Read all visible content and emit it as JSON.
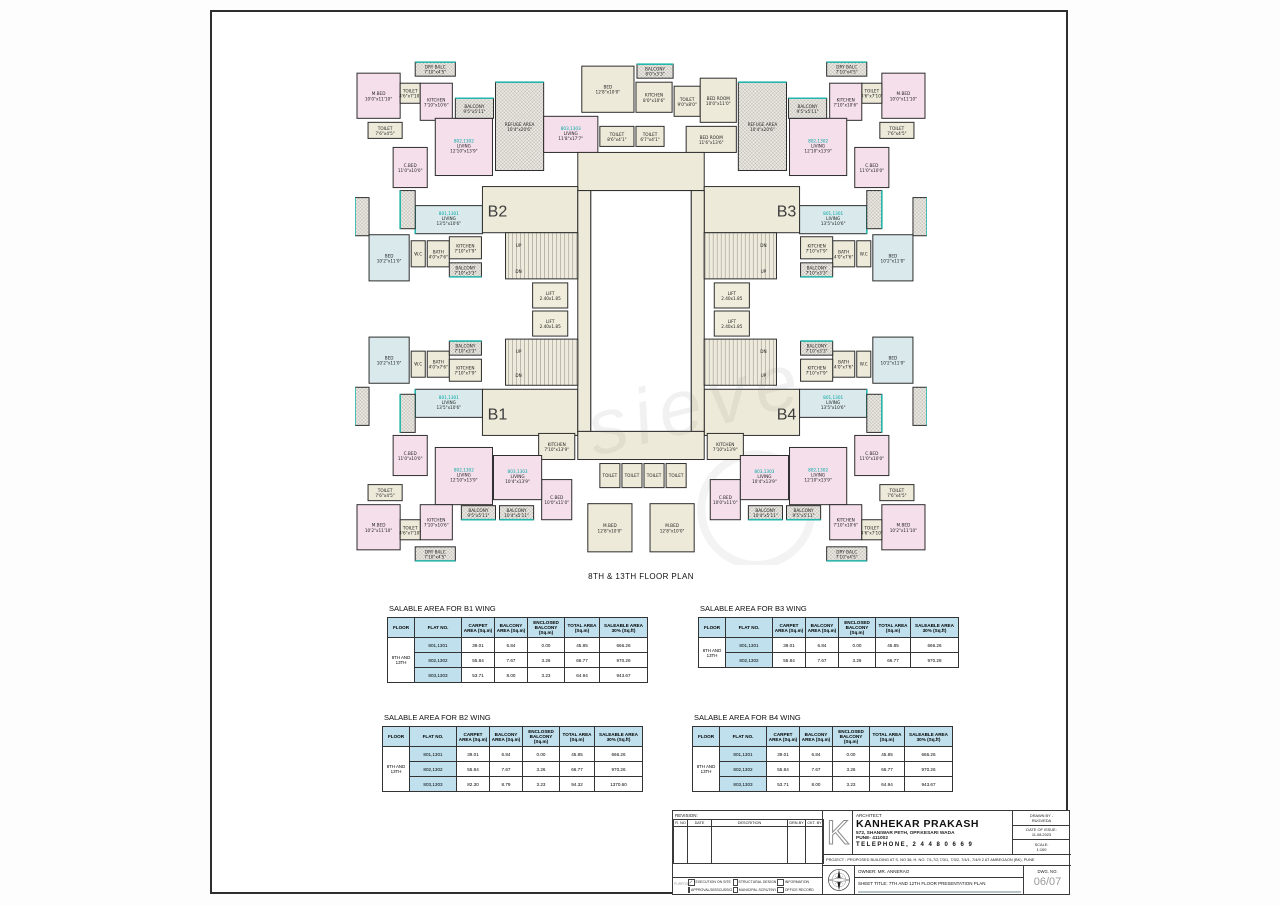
{
  "sheet": {
    "plan_title": "8TH & 13TH FLOOR PLAN",
    "watermark": "sieve"
  },
  "plan": {
    "wings": [
      {
        "label": "B2",
        "x": 142,
        "y": 158
      },
      {
        "label": "B3",
        "x": 430,
        "y": 158
      },
      {
        "label": "B1",
        "x": 142,
        "y": 360
      },
      {
        "label": "B4",
        "x": 430,
        "y": 360
      }
    ],
    "texts": [
      {
        "t": "UP",
        "x": 163,
        "y": 188
      },
      {
        "t": "DN",
        "x": 163,
        "y": 214
      },
      {
        "t": "UP",
        "x": 163,
        "y": 294
      },
      {
        "t": "DN",
        "x": 163,
        "y": 318
      },
      {
        "t": "DN",
        "x": 407,
        "y": 188
      },
      {
        "t": "UP",
        "x": 407,
        "y": 214
      },
      {
        "t": "DN",
        "x": 407,
        "y": 294
      },
      {
        "t": "UP",
        "x": 407,
        "y": 318
      }
    ],
    "rooms": [
      [
        140,
        24,
        48,
        88,
        "H",
        "REFUGE AREA",
        "10'4\"x20'6\"",
        "",
        "t"
      ],
      [
        382,
        24,
        48,
        88,
        "H",
        "REFUGE AREA",
        "10'4\"x20'6\"",
        "",
        "t"
      ],
      [
        226,
        8,
        52,
        46,
        "C",
        "BED",
        "12'8\"x10'0\""
      ],
      [
        281,
        6,
        36,
        14,
        "H",
        "BALCONY",
        "8'0\"x3'3\"",
        "",
        "t"
      ],
      [
        280,
        24,
        36,
        30,
        "C",
        "KITCHEN",
        "8'0\"x10'6\""
      ],
      [
        318,
        28,
        26,
        30,
        "C",
        "TOILET",
        "9'0\"x8'0\""
      ],
      [
        344,
        20,
        36,
        44,
        "C",
        "BED ROOM",
        "10'0\"x11'0\""
      ],
      [
        330,
        68,
        50,
        26,
        "C",
        "BED ROOM",
        "11'6\"x13'6\""
      ],
      [
        188,
        58,
        54,
        36,
        "P",
        "LIVING",
        "11'8\"x17'7\"",
        "803,1303"
      ],
      [
        244,
        68,
        34,
        20,
        "C",
        "TOILET",
        "8'6\"x4'1\""
      ],
      [
        280,
        68,
        28,
        20,
        "C",
        "TOILET",
        "6'7\"x4'1\""
      ],
      [
        222,
        94,
        126,
        38,
        "C"
      ],
      [
        2,
        15,
        43,
        45,
        "P",
        "M.BED",
        "10'0\"x11'10\""
      ],
      [
        60,
        4,
        40,
        14,
        "H",
        "DRY BALC",
        "7'10\"x4'5\"",
        "",
        "t"
      ],
      [
        45,
        25,
        20,
        20,
        "C",
        "TOILET",
        "4'6\"x7'10\""
      ],
      [
        65,
        25,
        32,
        37,
        "P",
        "KITCHEN",
        "7'10\"x10'6\""
      ],
      [
        13,
        64,
        34,
        16,
        "C",
        "TOILET",
        "7'6\"x4'5\""
      ],
      [
        38,
        89,
        34,
        40,
        "P",
        "C.BED",
        "11'0\"x10'0\""
      ],
      [
        80,
        60,
        57,
        57,
        "P",
        "LIVING",
        "12'10\"x13'9\"",
        "802,1302"
      ],
      [
        100,
        40,
        38,
        20,
        "H",
        "BALCONY",
        "9'5\"x5'11\"",
        "",
        "t"
      ],
      [
        60,
        147,
        67,
        28,
        "B",
        "LIVING",
        "13'5\"x10'6\"",
        "801,1301",
        "l"
      ],
      [
        45,
        132,
        15,
        38,
        "H",
        "",
        "",
        "",
        "l"
      ],
      [
        0,
        139,
        14,
        38,
        "H",
        "",
        "",
        "",
        "l"
      ],
      [
        525,
        15,
        43,
        45,
        "P",
        "M.BED",
        "10'0\"x11'10\""
      ],
      [
        470,
        4,
        40,
        14,
        "H",
        "DRY BALC",
        "7'10\"x4'5\"",
        "",
        "t"
      ],
      [
        505,
        25,
        20,
        20,
        "C",
        "TOILET",
        "4'6\"x7'10\""
      ],
      [
        473,
        25,
        32,
        37,
        "P",
        "KITCHEN",
        "7'10\"x10'6\""
      ],
      [
        523,
        64,
        34,
        16,
        "C",
        "TOILET",
        "7'6\"x4'5\""
      ],
      [
        498,
        89,
        34,
        40,
        "P",
        "C.BED",
        "11'0\"x10'0\""
      ],
      [
        433,
        60,
        57,
        57,
        "P",
        "LIVING",
        "12'10\"x13'9\"",
        "802,1302"
      ],
      [
        432,
        40,
        38,
        20,
        "H",
        "BALCONY",
        "9'5\"x5'11\"",
        "",
        "t"
      ],
      [
        443,
        147,
        67,
        28,
        "B",
        "LIVING",
        "13'5\"x10'6\"",
        "801,1301",
        "r"
      ],
      [
        510,
        132,
        15,
        38,
        "H",
        "",
        "",
        "",
        "r"
      ],
      [
        556,
        139,
        14,
        38,
        "H",
        "",
        "",
        "",
        "r"
      ],
      [
        14,
        176,
        40,
        46,
        "B",
        "BED",
        "10'2\"x11'0\""
      ],
      [
        56,
        182,
        14,
        26,
        "C",
        "W.C",
        ""
      ],
      [
        72,
        182,
        22,
        26,
        "C",
        "BATH",
        "4'0\"x7'6\""
      ],
      [
        94,
        178,
        32,
        22,
        "C",
        "KITCHEN",
        "7'10\"x7'9\""
      ],
      [
        94,
        204,
        32,
        14,
        "H",
        "BALCONY",
        "7'10\"x3'3\"",
        "",
        "b"
      ],
      [
        14,
        278,
        40,
        46,
        "B",
        "BED",
        "10'2\"x11'0\""
      ],
      [
        56,
        292,
        14,
        26,
        "C",
        "W.C",
        ""
      ],
      [
        72,
        292,
        22,
        26,
        "C",
        "BATH",
        "4'0\"x7'6\""
      ],
      [
        94,
        300,
        32,
        22,
        "C",
        "KITCHEN",
        "7'10\"x7'9\""
      ],
      [
        94,
        282,
        32,
        14,
        "H",
        "BALCONY",
        "7'10\"x3'3\"",
        "",
        "t"
      ],
      [
        516,
        176,
        40,
        46,
        "B",
        "BED",
        "10'2\"x11'0\""
      ],
      [
        500,
        182,
        14,
        26,
        "C",
        "W.C",
        ""
      ],
      [
        476,
        182,
        22,
        26,
        "C",
        "BATH",
        "4'0\"x7'6\""
      ],
      [
        444,
        178,
        32,
        22,
        "C",
        "KITCHEN",
        "7'10\"x7'9\""
      ],
      [
        444,
        204,
        32,
        14,
        "H",
        "BALCONY",
        "7'10\"x3'3\"",
        "",
        "b"
      ],
      [
        516,
        278,
        40,
        46,
        "B",
        "BED",
        "10'2\"x11'0\""
      ],
      [
        500,
        292,
        14,
        26,
        "C",
        "W.C",
        ""
      ],
      [
        476,
        292,
        22,
        26,
        "C",
        "BATH",
        "4'0\"x7'6\""
      ],
      [
        444,
        300,
        32,
        22,
        "C",
        "KITCHEN",
        "7'10\"x7'9\""
      ],
      [
        444,
        282,
        32,
        14,
        "H",
        "BALCONY",
        "7'10\"x3'3\"",
        "",
        "t"
      ],
      [
        127,
        128,
        95,
        46,
        "C"
      ],
      [
        348,
        128,
        95,
        46,
        "C"
      ],
      [
        127,
        330,
        95,
        46,
        "C"
      ],
      [
        348,
        330,
        95,
        46,
        "C"
      ],
      [
        222,
        132,
        13,
        240,
        "C"
      ],
      [
        335,
        132,
        13,
        240,
        "C"
      ],
      [
        235,
        132,
        100,
        240,
        "W"
      ],
      [
        150,
        174,
        72,
        46,
        "S"
      ],
      [
        177,
        224,
        35,
        25,
        "L",
        "LIFT",
        "2.40x1.85"
      ],
      [
        177,
        252,
        35,
        25,
        "L",
        "LIFT",
        "2.40x1.85"
      ],
      [
        150,
        280,
        72,
        46,
        "S"
      ],
      [
        348,
        174,
        72,
        46,
        "S"
      ],
      [
        358,
        224,
        35,
        25,
        "L",
        "LIFT",
        "2.40x1.85"
      ],
      [
        358,
        252,
        35,
        25,
        "L",
        "LIFT",
        "2.40x1.85"
      ],
      [
        348,
        280,
        72,
        46,
        "S"
      ],
      [
        222,
        372,
        126,
        28,
        "C"
      ],
      [
        183,
        374,
        36,
        26,
        "C",
        "KITCHEN",
        "7'10\"x13'9\""
      ],
      [
        351,
        374,
        36,
        26,
        "C",
        "KITCHEN",
        "7'10\"x13'9\""
      ],
      [
        244,
        404,
        20,
        24,
        "C",
        "TOILET",
        ""
      ],
      [
        266,
        404,
        20,
        24,
        "C",
        "TOILET",
        ""
      ],
      [
        288,
        404,
        20,
        24,
        "C",
        "TOILET",
        ""
      ],
      [
        310,
        404,
        20,
        24,
        "C",
        "TOILET",
        ""
      ],
      [
        232,
        444,
        44,
        48,
        "C",
        "M.BED",
        "12'8\"x10'0\""
      ],
      [
        294,
        444,
        44,
        48,
        "C",
        "M.BED",
        "12'8\"x10'0\""
      ],
      [
        186,
        420,
        30,
        40,
        "P",
        "C.BED",
        "10'0\"x11'0\""
      ],
      [
        354,
        420,
        30,
        40,
        "P",
        "C.BED",
        "10'0\"x11'0\""
      ],
      [
        138,
        396,
        48,
        44,
        "P",
        "LIVING",
        "10'4\"x13'9\"",
        "803,1303"
      ],
      [
        384,
        396,
        48,
        44,
        "P",
        "LIVING",
        "10'4\"x13'9\"",
        "803,1303"
      ],
      [
        106,
        446,
        34,
        14,
        "H",
        "BALCONY",
        "9'5\"x5'11\"",
        "",
        "b"
      ],
      [
        144,
        446,
        34,
        14,
        "H",
        "BALCONY",
        "10'4\"x5'11\"",
        "",
        "b"
      ],
      [
        430,
        446,
        34,
        14,
        "H",
        "BALCONY",
        "9'5\"x5'11\"",
        "",
        "b"
      ],
      [
        392,
        446,
        34,
        14,
        "H",
        "BALCONY",
        "10'4\"x5'11\"",
        "",
        "b"
      ],
      [
        60,
        330,
        67,
        28,
        "B",
        "LIVING",
        "13'5\"x10'6\"",
        "801,1301",
        "l"
      ],
      [
        45,
        335,
        15,
        38,
        "H",
        "",
        "",
        "",
        "l"
      ],
      [
        0,
        328,
        14,
        38,
        "H",
        "",
        "",
        "",
        "l"
      ],
      [
        38,
        376,
        34,
        40,
        "P",
        "C.BED",
        "11'0\"x10'0\""
      ],
      [
        80,
        388,
        57,
        57,
        "P",
        "LIVING",
        "12'10\"x13'9\"",
        "802,1302"
      ],
      [
        2,
        445,
        43,
        45,
        "P",
        "M.BED",
        "10'2\"x11'10\""
      ],
      [
        13,
        425,
        34,
        16,
        "C",
        "TOILET",
        "7'6\"x4'5\""
      ],
      [
        65,
        445,
        32,
        35,
        "P",
        "KITCHEN",
        "7'10\"x10'6\""
      ],
      [
        45,
        460,
        20,
        20,
        "C",
        "TOILET",
        "4'6\"x7'10\""
      ],
      [
        60,
        487,
        40,
        14,
        "H",
        "DRY BALC",
        "7'10\"x4'5\"",
        "",
        "b"
      ],
      [
        443,
        330,
        67,
        28,
        "B",
        "LIVING",
        "13'5\"x10'6\"",
        "801,1301",
        "r"
      ],
      [
        510,
        335,
        15,
        38,
        "H",
        "",
        "",
        "",
        "r"
      ],
      [
        556,
        328,
        14,
        38,
        "H",
        "",
        "",
        "",
        "r"
      ],
      [
        498,
        376,
        34,
        40,
        "P",
        "C.BED",
        "11'0\"x10'0\""
      ],
      [
        433,
        388,
        57,
        57,
        "P",
        "LIVING",
        "12'10\"x13'9\"",
        "802,1302"
      ],
      [
        525,
        445,
        43,
        45,
        "P",
        "M.BED",
        "10'2\"x11'10\""
      ],
      [
        523,
        425,
        34,
        16,
        "C",
        "TOILET",
        "7'6\"x4'5\""
      ],
      [
        473,
        445,
        32,
        35,
        "P",
        "KITCHEN",
        "7'10\"x10'6\""
      ],
      [
        505,
        460,
        20,
        20,
        "C",
        "TOILET",
        "4'6\"x7'10\""
      ],
      [
        470,
        487,
        40,
        14,
        "H",
        "DRY BALC",
        "7'10\"x4'5\"",
        "",
        "b"
      ]
    ]
  },
  "tables": {
    "headers": [
      "FLOOR",
      "FLAT NO.",
      "CARPET AREA (Sq.m)",
      "BALCONY AREA (Sq.m)",
      "ENCLOSED BALCONY (Sq.m)",
      "TOTAL AREA (Sq.m)",
      "SALEABLE AREA 30% (Sq.ft)"
    ],
    "floor_label": "8TH AND 13TH",
    "list": [
      {
        "title": "SALABLE AREA FOR B1 WING",
        "rows": [
          [
            "801,1301",
            "39.01",
            "6.84",
            "0.00",
            "45.85",
            "666.26"
          ],
          [
            "802,1302",
            "55.84",
            "7.67",
            "3.26",
            "66.77",
            "970.26"
          ],
          [
            "803,1303",
            "53.71",
            "8.00",
            "3.23",
            "64.94",
            "943.67"
          ]
        ]
      },
      {
        "title": "SALABLE AREA FOR B3 WING",
        "rows": [
          [
            "801,1301",
            "39.01",
            "6.84",
            "0.00",
            "45.85",
            "666.26"
          ],
          [
            "802,1302",
            "55.84",
            "7.67",
            "3.26",
            "66.77",
            "970.28"
          ]
        ]
      },
      {
        "title": "SALABLE AREA FOR B2 WING",
        "rows": [
          [
            "801,1301",
            "39.01",
            "6.84",
            "0.00",
            "45.85",
            "666.26"
          ],
          [
            "802,1302",
            "55.84",
            "7.67",
            "3.26",
            "66.77",
            "970.26"
          ],
          [
            "803,1303",
            "82.30",
            "8.79",
            "3.23",
            "94.32",
            "1370.60"
          ]
        ]
      },
      {
        "title": "SALABLE AREA FOR B4 WING",
        "rows": [
          [
            "801,1301",
            "39.01",
            "6.84",
            "0.00",
            "45.85",
            "666.26"
          ],
          [
            "802,1302",
            "55.84",
            "7.67",
            "3.26",
            "66.77",
            "970.26"
          ],
          [
            "803,1303",
            "53.71",
            "8.00",
            "3.23",
            "64.94",
            "943.67"
          ]
        ]
      }
    ]
  },
  "title_block": {
    "revision_label": "REVISION:",
    "revision_headers": [
      "R. NO",
      "DATE",
      "DESCRITION",
      "DRN.BY",
      "CKT. BY"
    ],
    "purpose": {
      "label": "PURPOSE",
      "items": [
        {
          "label": "EXECUTION ON SITE",
          "checked": true
        },
        {
          "label": "STRUCTURAL DESIGN",
          "checked": false
        },
        {
          "label": "INFORMATION",
          "checked": false
        },
        {
          "label": "APPROVAL/DISSCUSSION",
          "checked": false
        },
        {
          "label": "MUNICIPAL SCRUTINY",
          "checked": false
        },
        {
          "label": "OFFICE RECORD",
          "checked": false
        }
      ]
    },
    "architect_label": "ARCHITECT",
    "architect_name": "KANHEKAR PRAKASH",
    "address1": "572, SHANIWAR PETH, OPP.KESARI WADA",
    "address2": "PUNE- 411002",
    "phone": "TELEPHONE, 2 4 4 8 0 6 6 9",
    "drawn_by_label": "DRAWN BY -",
    "drawn_by": "RUGVEDA",
    "date_label": "DATE OF ISSUE:",
    "date_value": "11.08.2023",
    "scale_label": "SCALE:",
    "scale_value": "1:100",
    "project_line": "PROJECT : PROPOSED BUILDING AT S. NO 36, H. NO. 7/1,7/2,7/3/1, 7/3/2, 7/4/1, 7/4/9 2 AT AMBEGAON (BK), PUNE",
    "owner_line": "OWNER: MR. ANNERAO",
    "sheet_title_line": "SHEET TITLE: 7TH AND 12TH FLOOR PRESENTATION PLAN",
    "dwg_label": "DWG. NO:",
    "dwg_value": "06/07"
  }
}
